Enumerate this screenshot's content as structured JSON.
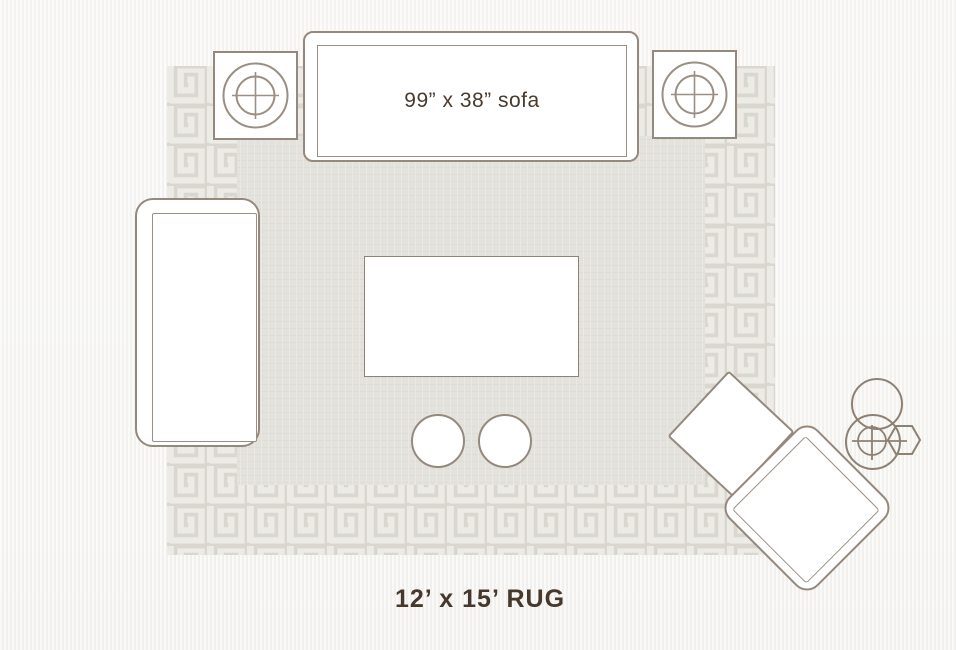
{
  "background_color": "#f6f5f3",
  "rug": {
    "label": "12’ x 15’ RUG",
    "field_color": "#e4e2dc",
    "border_band_color": "#ecebe6",
    "fret_pattern_color": "#d6d4cd"
  },
  "sofa": {
    "label": "99” x 38” sofa"
  },
  "style": {
    "furniture_outline_color": "#95897d",
    "furniture_fill_color": "#ffffff",
    "label_text_color": "#46382c"
  },
  "furniture_items": [
    "sofa",
    "side-table-left",
    "side-table-right",
    "chaise",
    "coffee-table",
    "round-ottoman-1",
    "round-ottoman-2",
    "square-ottoman",
    "accent-chair",
    "accent-table-cluster"
  ]
}
